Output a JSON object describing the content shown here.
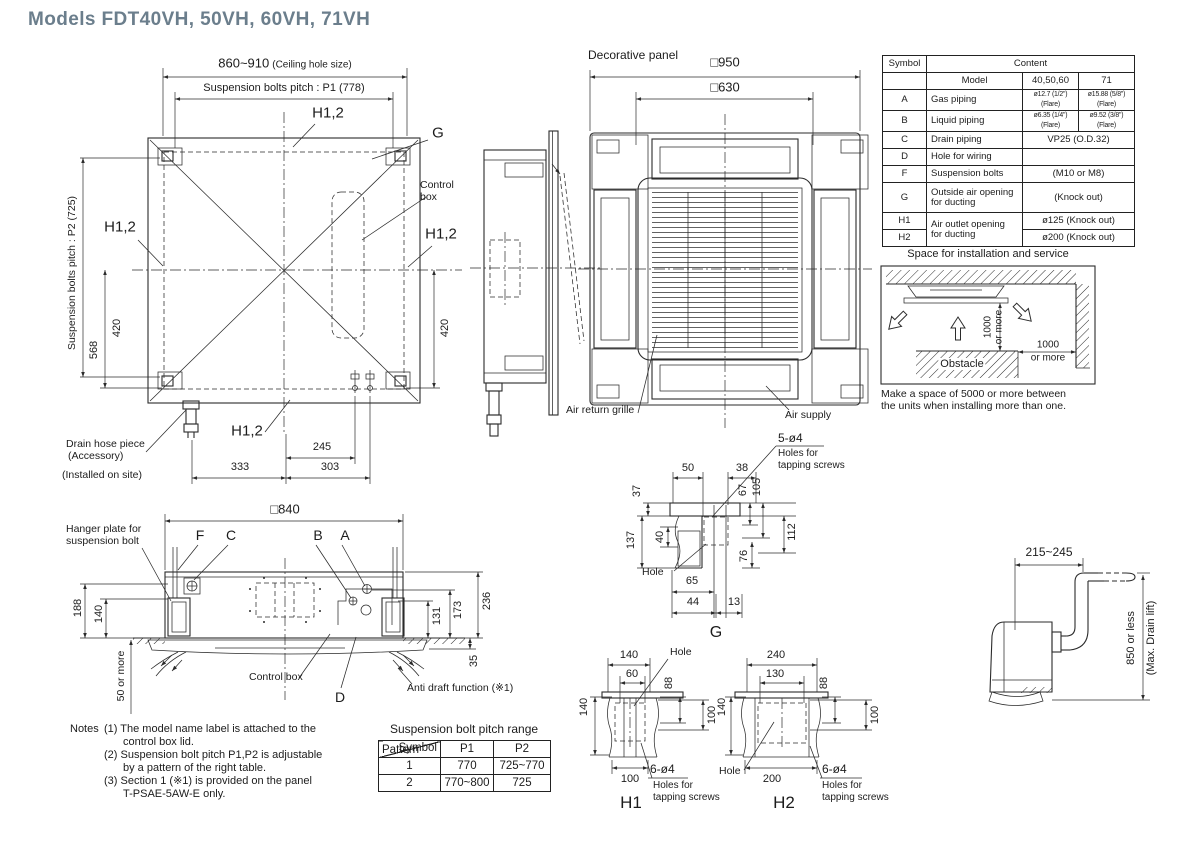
{
  "title": "Models  FDT40VH, 50VH, 60VH, 71VH",
  "plan": {
    "dim_ceiling": "860~910",
    "dim_ceiling_note": "(Ceiling hole size)",
    "dim_p1": "Suspension bolts pitch : P1 (778)",
    "dim_p2": "Suspension bolts pitch : P2 (725)",
    "h12": "H1,2",
    "g": "G",
    "control_box": "Control\nbox",
    "dim_568": "568",
    "dim_420": "420",
    "dim_245": "245",
    "dim_333": "333",
    "dim_303": "303",
    "drain1": "Drain hose piece",
    "drain2": "(Accessory)",
    "drain3": "(Installed on site)"
  },
  "panel": {
    "title": "Decorative panel",
    "dim_outer": "□950",
    "dim_inner": "□630",
    "air_return": "Air return grille",
    "air_supply": "Air supply"
  },
  "spec": {
    "h_symbol": "Symbol",
    "h_content": "Content",
    "h_model": "Model",
    "h_m1": "40,50,60",
    "h_m2": "71",
    "a": "A",
    "a_name": "Gas piping",
    "a_v1": "ø12.7 (1/2\") (Flare)",
    "a_v2": "ø15.88 (5/8\") (Flare)",
    "b": "B",
    "b_name": "Liquid piping",
    "b_v1": "ø6.35 (1/4\") (Flare)",
    "b_v2": "ø9.52 (3/8\") (Flare)",
    "c": "C",
    "c_name": "Drain piping",
    "c_v": "VP25 (O.D.32)",
    "d": "D",
    "d_name": "Hole for wiring",
    "d_v": "",
    "f": "F",
    "f_name": "Suspension bolts",
    "f_v": "(M10 or M8)",
    "g": "G",
    "g_name": "Outside air opening\nfor ducting",
    "g_v": "(Knock out)",
    "h1": "H1",
    "h2": "H2",
    "h_name": "Air outlet opening\nfor ducting",
    "h1_v": "ø125 (Knock out)",
    "h2_v": "ø200 (Knock out)"
  },
  "space": {
    "title": "Space for installation and service",
    "v1": "1000",
    "v2": "or more",
    "hz1": "1000",
    "hz2": "or more",
    "obstacle": "Obstacle",
    "note": "Make a space of 5000 or more between\nthe units when installing more than one."
  },
  "elev": {
    "dim_840": "□840",
    "hanger": "Hanger plate for\nsuspension bolt",
    "f": "F",
    "c": "C",
    "b": "B",
    "a": "A",
    "dim_188": "188",
    "dim_140": "140",
    "dim_50": "50 or more",
    "dim_131": "131",
    "dim_173": "173",
    "dim_236": "236",
    "dim_35": "35",
    "control_box": "Control box",
    "d": "D",
    "anti_draft": "Anti draft function (※1)"
  },
  "notes": {
    "label": "Notes",
    "n1": "(1) The model name label is attached to the\ncontrol box lid.",
    "n2": "(2) Suspension bolt pitch P1,P2 is adjustable\nby a pattern of the right table.",
    "n3": "(3) Section 1 (※1) is provided on the panel\nT-PSAE-5AW-E only."
  },
  "pitch": {
    "title": "Suspension bolt pitch range",
    "diag_top": "Symbol",
    "diag_bottom": "Pattern",
    "p1": "P1",
    "p2": "P2",
    "r1c1": "1",
    "r1c2": "770",
    "r1c3": "725~770",
    "r2c1": "2",
    "r2c2": "770~800",
    "r2c3": "725"
  },
  "dg": {
    "screws": "5-ø4",
    "screws2": "Holes for\ntapping screws",
    "hole": "Hole",
    "cap": "G",
    "d50": "50",
    "d38": "38",
    "d37": "37",
    "d67": "67",
    "d105": "105",
    "d137": "137",
    "d40": "40",
    "d112": "112",
    "d76": "76",
    "d65": "65",
    "d44": "44",
    "d13": "13"
  },
  "dh1": {
    "d140t": "140",
    "d60": "60",
    "hole": "Hole",
    "d88": "88",
    "d140": "140",
    "d100r": "100",
    "d100b": "100",
    "screws": "6-ø4",
    "screws2": "Holes for\ntapping screws",
    "cap": "H1"
  },
  "dh2": {
    "d240": "240",
    "d130": "130",
    "hole": "Hole",
    "d88": "88",
    "d140": "140",
    "d100r": "100",
    "d200": "200",
    "screws": "6-ø4",
    "screws2": "Holes for\ntapping screws",
    "cap": "H2"
  },
  "drain": {
    "dim": "215~245",
    "v1": "850 or less",
    "v2": "(Max. Drain lift)"
  }
}
